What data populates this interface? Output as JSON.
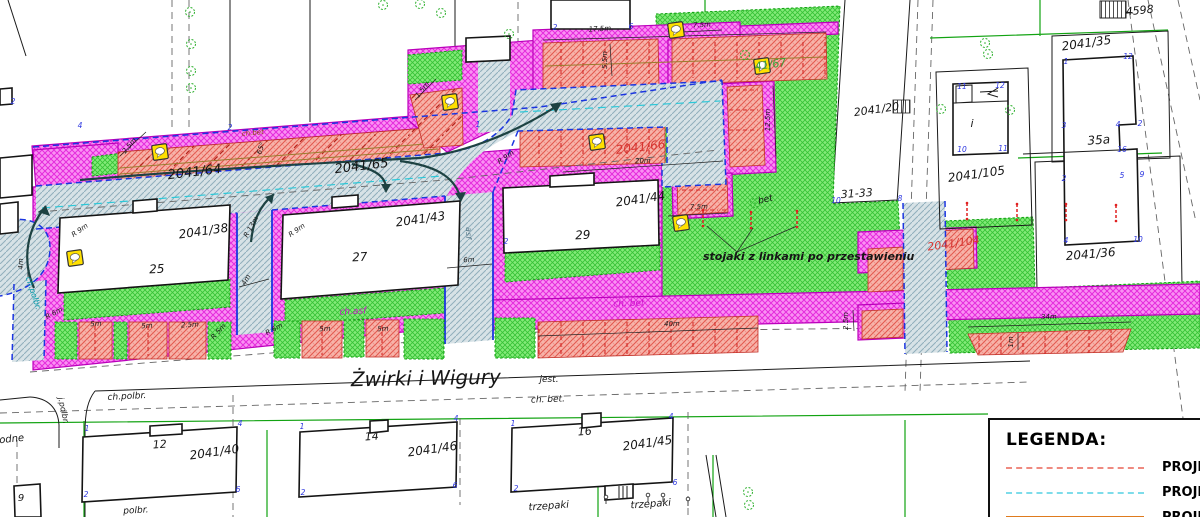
{
  "street": {
    "name": "Żwirki i Wigury"
  },
  "legend": {
    "title": "LEGENDA:",
    "entries": [
      {
        "label": "PROJEK",
        "color": "#ef8a80",
        "style": "dashed"
      },
      {
        "label": "PROJEK",
        "color": "#7ddcea",
        "style": "dashed"
      },
      {
        "label": "PROJEK",
        "color": "#df7b1e",
        "style": "solid"
      }
    ]
  },
  "colors": {
    "sidewalk_magenta": "#fa90f3",
    "parking_red": "#f7b3a9",
    "lawn_green": "#83ea78",
    "road_gray": "#d7e2e6",
    "boundary_blue": "#1b35e0",
    "axis_cyan": "#2bc8d8"
  },
  "labels": [
    {
      "t": "2041/64",
      "x": 195,
      "y": 176,
      "r": -7,
      "s": 13,
      "n": "parcel-label"
    },
    {
      "t": "2041/65",
      "x": 362,
      "y": 170,
      "r": -7,
      "s": 13,
      "n": "parcel-label"
    },
    {
      "t": "2041/66",
      "x": 641,
      "y": 151,
      "r": -7,
      "s": 12,
      "c": "#d63430",
      "n": "parcel-label"
    },
    {
      "t": "2041/44",
      "x": 641,
      "y": 203,
      "r": -8,
      "s": 12,
      "n": "parcel-label"
    },
    {
      "t": "2041/43",
      "x": 421,
      "y": 223,
      "r": -8,
      "s": 12,
      "n": "parcel-label"
    },
    {
      "t": "2041/38",
      "x": 204,
      "y": 235,
      "r": -8,
      "s": 12,
      "n": "parcel-label"
    },
    {
      "t": "2041/20",
      "x": 877,
      "y": 113,
      "r": -8,
      "s": 11,
      "n": "parcel-label"
    },
    {
      "t": "31-33",
      "x": 857,
      "y": 197,
      "r": -4,
      "s": 11,
      "n": "parcel-label"
    },
    {
      "t": "2041/35",
      "x": 1087,
      "y": 47,
      "r": -8,
      "s": 12,
      "n": "parcel-label"
    },
    {
      "t": "35a",
      "x": 1099,
      "y": 144,
      "r": -4,
      "s": 12,
      "n": "building-label"
    },
    {
      "t": "2041/105",
      "x": 977,
      "y": 178,
      "r": -8,
      "s": 12,
      "n": "parcel-label"
    },
    {
      "t": "2041/36",
      "x": 1091,
      "y": 258,
      "r": -5,
      "s": 12,
      "n": "parcel-label"
    },
    {
      "t": "4598",
      "x": 1140,
      "y": 14,
      "r": -6,
      "s": 11,
      "n": "parcel-label"
    },
    {
      "t": "41/67",
      "x": 771,
      "y": 68,
      "r": -8,
      "s": 11,
      "c": "#3aa03a",
      "n": "parcel-label"
    },
    {
      "t": "2041/104",
      "x": 954,
      "y": 247,
      "r": -8,
      "s": 11,
      "c": "#d63430",
      "n": "parcel-label"
    },
    {
      "t": "2041/40",
      "x": 215,
      "y": 456,
      "r": -8,
      "s": 12,
      "n": "parcel-label"
    },
    {
      "t": "2041/46",
      "x": 433,
      "y": 453,
      "r": -8,
      "s": 12,
      "n": "parcel-label"
    },
    {
      "t": "2041/45",
      "x": 648,
      "y": 447,
      "r": -8,
      "s": 12,
      "n": "parcel-label"
    },
    {
      "t": "i",
      "x": 972,
      "y": 127,
      "r": 0,
      "s": 11,
      "n": "building-label"
    },
    {
      "t": "12",
      "x": 160,
      "y": 448,
      "r": -4,
      "s": 11,
      "n": "building-label"
    },
    {
      "t": "14",
      "x": 372,
      "y": 440,
      "r": -4,
      "s": 11,
      "n": "building-label"
    },
    {
      "t": "16",
      "x": 585,
      "y": 435,
      "r": -4,
      "s": 11,
      "n": "building-label"
    },
    {
      "t": "25",
      "x": 157,
      "y": 273,
      "r": -3,
      "s": 12,
      "n": "building-label"
    },
    {
      "t": "27",
      "x": 360,
      "y": 261,
      "r": -3,
      "s": 12,
      "n": "building-label"
    },
    {
      "t": "29",
      "x": 583,
      "y": 239,
      "r": -3,
      "s": 12,
      "n": "building-label"
    },
    {
      "t": "9",
      "x": 21,
      "y": 501,
      "r": 0,
      "s": 10,
      "n": "building-label"
    },
    {
      "t": "odne",
      "x": 12,
      "y": 442,
      "r": -6,
      "s": 10,
      "n": "edge-text-fragment"
    },
    {
      "t": "Żwirki i Wigury",
      "x": 426,
      "y": 385,
      "r": -1,
      "s": 20,
      "serif": true,
      "n": "street-name"
    },
    {
      "t": "jest.",
      "x": 549,
      "y": 382,
      "r": 0,
      "s": 9,
      "n": "surface-note"
    },
    {
      "t": "ch. bet.",
      "x": 548,
      "y": 402,
      "r": -2,
      "s": 9,
      "n": "surface-note"
    },
    {
      "t": "ch.polbr.",
      "x": 127,
      "y": 399,
      "r": -3,
      "s": 9,
      "n": "surface-note"
    },
    {
      "t": "polbr.",
      "x": 136,
      "y": 513,
      "r": -3,
      "s": 9,
      "n": "surface-note"
    },
    {
      "t": "trzepaki",
      "x": 549,
      "y": 509,
      "r": -4,
      "s": 10,
      "n": "surface-note"
    },
    {
      "t": "trzepaki",
      "x": 651,
      "y": 507,
      "r": -4,
      "s": 10,
      "n": "surface-note"
    },
    {
      "t": "ch. bet",
      "x": 629,
      "y": 306,
      "r": -2,
      "s": 9,
      "c": "#cc10cc",
      "n": "surface-note"
    },
    {
      "t": "ch.asf",
      "x": 353,
      "y": 314,
      "r": -3,
      "s": 9,
      "c": "#cc10cc",
      "n": "surface-note"
    },
    {
      "t": "ch.bet",
      "x": 253,
      "y": 135,
      "r": -5,
      "s": 7,
      "c": "#8a4a10",
      "n": "surface-note"
    },
    {
      "t": "asf",
      "x": 466,
      "y": 233,
      "r": 90,
      "s": 8,
      "c": "#557788",
      "n": "surface-note"
    },
    {
      "t": "j.polbr.",
      "x": 61,
      "y": 411,
      "r": 78,
      "s": 8,
      "n": "surface-note"
    },
    {
      "t": "ch.polbr.",
      "x": 31,
      "y": 294,
      "r": 72,
      "s": 8,
      "c": "#0099aa",
      "n": "surface-note"
    },
    {
      "t": "bet",
      "x": 766,
      "y": 202,
      "r": -14,
      "s": 9,
      "n": "surface-note"
    },
    {
      "t": "stojaki z linkami po przestawieniu",
      "x": 703,
      "y": 260,
      "r": 0,
      "s": 11,
      "b": true,
      "a": "start",
      "n": "note-stojaki"
    }
  ],
  "dims": [
    [
      "17.5m",
      600,
      31,
      -3
    ],
    [
      "7.5m",
      702,
      27,
      -3
    ],
    [
      "5.5m",
      607,
      60,
      -90
    ],
    [
      "12.5m",
      770,
      120,
      -90
    ],
    [
      "20m",
      643,
      163,
      -3
    ],
    [
      "7.5m",
      699,
      209,
      -2
    ],
    [
      "40m",
      672,
      326,
      -2
    ],
    [
      "34m",
      1049,
      319,
      -2
    ],
    [
      "2.5m",
      848,
      321,
      -90
    ],
    [
      "1m",
      1013,
      342,
      -90
    ],
    [
      "6m",
      469,
      262,
      -3
    ],
    [
      "4m",
      23,
      264,
      -90
    ],
    [
      "4m",
      248,
      281,
      -60
    ],
    [
      "R 9m",
      81,
      232,
      -35
    ],
    [
      "R 9m",
      298,
      232,
      -35
    ],
    [
      "R 9m",
      507,
      159,
      -35
    ],
    [
      "R 13m",
      253,
      228,
      -60
    ],
    [
      "R 6m",
      55,
      315,
      -28
    ],
    [
      "R 6m",
      275,
      331,
      -28
    ],
    [
      "R 5m",
      220,
      333,
      -48
    ],
    [
      "5m",
      96,
      326,
      -3
    ],
    [
      "5m",
      147,
      328,
      -3
    ],
    [
      "2.5m",
      190,
      327,
      -3
    ],
    [
      "5m",
      325,
      331,
      -3
    ],
    [
      "5m",
      383,
      331,
      -3
    ],
    [
      "2.5m",
      131,
      147,
      -50
    ],
    [
      "1.5m",
      424,
      91,
      -52
    ],
    [
      "65°",
      263,
      149,
      -70
    ]
  ],
  "vertex_numbers": [
    [
      "2",
      13,
      104
    ],
    [
      "4",
      80,
      128
    ],
    [
      "1",
      478,
      127
    ],
    [
      "2",
      230,
      130
    ],
    [
      "2",
      555,
      30
    ],
    [
      "6",
      631,
      29
    ],
    [
      "2",
      506,
      244
    ],
    [
      "8",
      900,
      201
    ],
    [
      "10",
      836,
      203
    ],
    [
      "1",
      87,
      431
    ],
    [
      "4",
      240,
      426
    ],
    [
      "2",
      86,
      497
    ],
    [
      "6",
      238,
      492
    ],
    [
      "1",
      302,
      429
    ],
    [
      "4",
      456,
      421
    ],
    [
      "2",
      303,
      495
    ],
    [
      "6",
      455,
      488
    ],
    [
      "1",
      513,
      426
    ],
    [
      "4",
      671,
      419
    ],
    [
      "2",
      516,
      491
    ],
    [
      "6",
      675,
      485
    ],
    [
      "1",
      1066,
      64
    ],
    [
      "12",
      1128,
      59
    ],
    [
      "3",
      1064,
      128
    ],
    [
      "4",
      1118,
      127
    ],
    [
      "2",
      1140,
      126
    ],
    [
      "16",
      1122,
      152
    ],
    [
      "2",
      1064,
      181
    ],
    [
      "5",
      1122,
      178
    ],
    [
      "9",
      1142,
      177
    ],
    [
      "4",
      1066,
      243
    ],
    [
      "10",
      1138,
      242
    ],
    [
      "11",
      962,
      89
    ],
    [
      "12",
      1000,
      88
    ],
    [
      "10",
      962,
      152
    ],
    [
      "11",
      1003,
      151
    ]
  ],
  "trees": [
    [
      190,
      12
    ],
    [
      191,
      44
    ],
    [
      191,
      71
    ],
    [
      191,
      88
    ],
    [
      383,
      5
    ],
    [
      420,
      4
    ],
    [
      441,
      13
    ],
    [
      509,
      34
    ],
    [
      985,
      43
    ],
    [
      988,
      54
    ],
    [
      941,
      109
    ],
    [
      1010,
      110
    ],
    [
      745,
      55
    ],
    [
      755,
      203
    ],
    [
      748,
      492
    ],
    [
      749,
      505
    ]
  ],
  "signs": [
    [
      75,
      258
    ],
    [
      160,
      152
    ],
    [
      450,
      102
    ],
    [
      597,
      142
    ],
    [
      676,
      30
    ],
    [
      762,
      66
    ],
    [
      681,
      223
    ]
  ],
  "rack_markers": [
    [
      703,
      218
    ],
    [
      751,
      220
    ],
    [
      797,
      219
    ],
    [
      967,
      211
    ],
    [
      1017,
      212
    ],
    [
      1066,
      212
    ],
    [
      1116,
      213
    ]
  ],
  "posts": [
    [
      606,
      497
    ],
    [
      648,
      495
    ],
    [
      663,
      495
    ],
    [
      688,
      499
    ]
  ]
}
